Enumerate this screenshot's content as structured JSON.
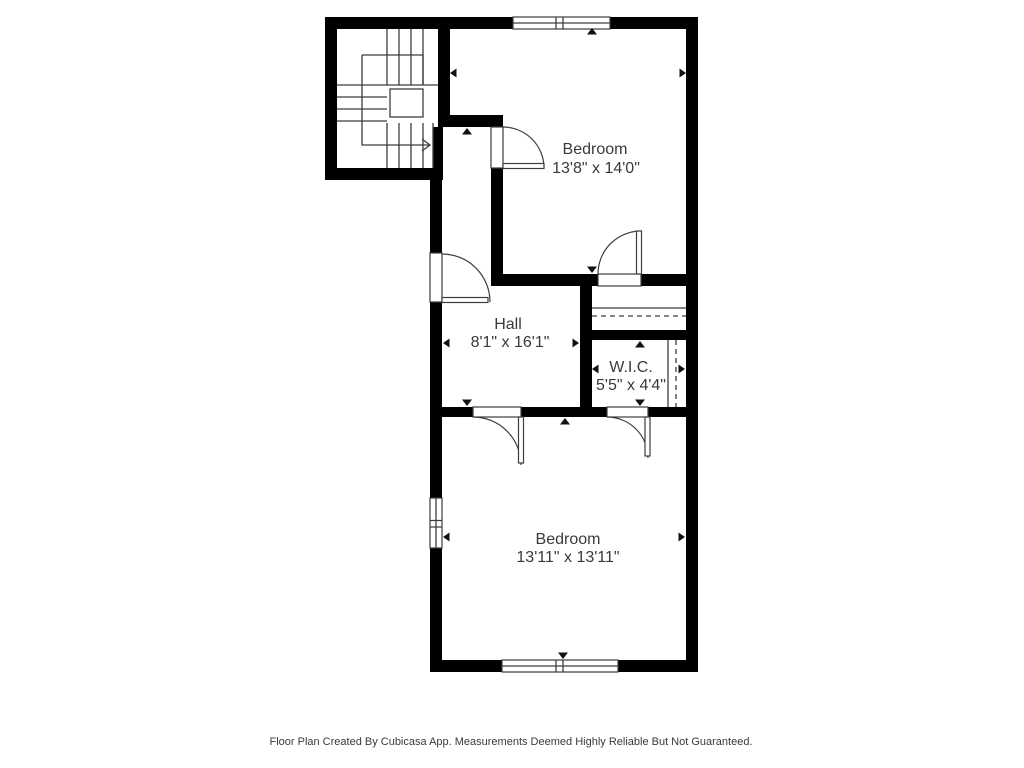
{
  "rooms": [
    {
      "name": "Bedroom",
      "dimensions": "13'8\" x 14'0\""
    },
    {
      "name": "Hall",
      "dimensions": "8'1\" x 16'1\""
    },
    {
      "name": "W.I.C.",
      "dimensions": "5'5\" x 4'4\""
    },
    {
      "name": "Bedroom",
      "dimensions": "13'11\" x 13'11\""
    }
  ],
  "footer": {
    "disclaimer": "Floor Plan Created By Cubicasa App. Measurements Deemed Highly Reliable But Not Guaranteed."
  },
  "colors": {
    "wall": "#000000",
    "line": "#3d3d3d",
    "marker": "#111111",
    "text": "#3a3a3a",
    "background": "#ffffff"
  }
}
